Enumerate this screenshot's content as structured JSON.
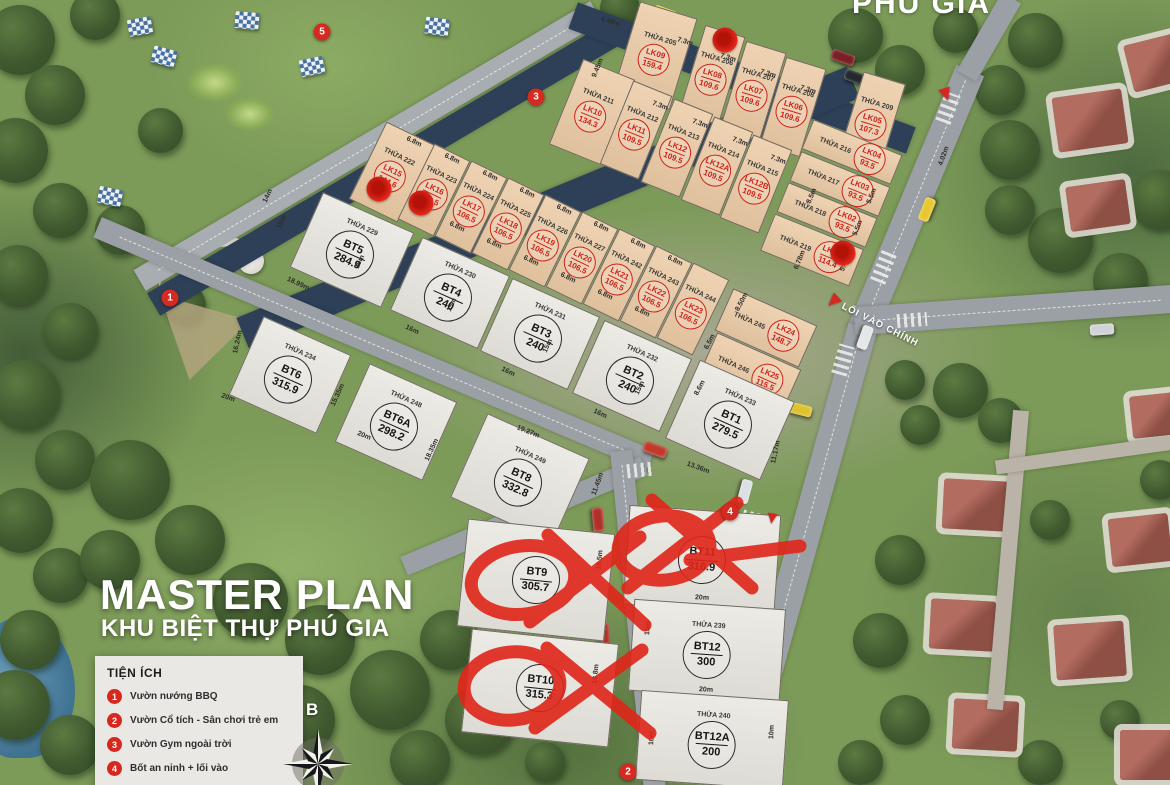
{
  "title": {
    "line1": "MASTER PLAN",
    "line2": "KHU BIỆT THỰ PHÚ GIA"
  },
  "watermark": "PHU GIA",
  "compass_label": "B",
  "entrance_label": "LỐI VÀO CHÍNH",
  "legend": {
    "title": "TIỆN ÍCH",
    "items": [
      {
        "num": "1",
        "label": "Vườn nướng BBQ"
      },
      {
        "num": "2",
        "label": "Vườn Cổ tích - Sân chơi trẻ em"
      },
      {
        "num": "3",
        "label": "Vườn Gym ngoài trời"
      },
      {
        "num": "4",
        "label": "Bốt an ninh + lối vào"
      }
    ]
  },
  "colors": {
    "annotation_red": "#e02519",
    "lk_badge_red": "#cf2319",
    "bt_badge_black": "#151515",
    "lk_fill": "#ebcba6",
    "bt_fill": "#e9e7e0"
  },
  "crossed_out_lots": [
    "BT9",
    "BT10",
    "BT11"
  ],
  "lots": [
    {
      "code": "LK09",
      "area": "159.4",
      "thua": "THỬA 205",
      "x": 655,
      "y": 55,
      "w": 60,
      "h": 95,
      "r": 17,
      "t": "lk"
    },
    {
      "code": "LK08",
      "area": "109.6",
      "thua": "THỬA 206",
      "x": 712,
      "y": 75,
      "w": 42,
      "h": 92,
      "r": 17,
      "t": "lk"
    },
    {
      "code": "LK07",
      "area": "109.6",
      "thua": "THỬA 207",
      "x": 753,
      "y": 91,
      "w": 42,
      "h": 92,
      "r": 17,
      "t": "lk"
    },
    {
      "code": "LK06",
      "area": "109.6",
      "thua": "THỬA 208",
      "x": 793,
      "y": 107,
      "w": 42,
      "h": 92,
      "r": 17,
      "t": "lk"
    },
    {
      "code": "LK05",
      "area": "107.3",
      "thua": "THỬA 209",
      "x": 872,
      "y": 120,
      "w": 44,
      "h": 88,
      "r": 17,
      "t": "lk"
    },
    {
      "code": "LK10",
      "area": "134.3",
      "thua": "THỬA 211",
      "x": 592,
      "y": 112,
      "w": 56,
      "h": 92,
      "r": 22,
      "t": "lk"
    },
    {
      "code": "LK11",
      "area": "109.5",
      "thua": "THỬA 212",
      "x": 636,
      "y": 130,
      "w": 42,
      "h": 90,
      "r": 22,
      "t": "lk"
    },
    {
      "code": "LK12",
      "area": "109.5",
      "thua": "THỬA 213",
      "x": 677,
      "y": 148,
      "w": 42,
      "h": 90,
      "r": 22,
      "t": "lk"
    },
    {
      "code": "LK12A",
      "area": "109.5",
      "thua": "THỬA 214",
      "x": 717,
      "y": 166,
      "w": 42,
      "h": 90,
      "r": 22,
      "t": "lk"
    },
    {
      "code": "LK12B",
      "area": "109.5",
      "thua": "THỬA 215",
      "x": 756,
      "y": 184,
      "w": 42,
      "h": 90,
      "r": 22,
      "t": "lk"
    },
    {
      "code": "LK04",
      "area": "93.5",
      "thua": "THỬA 216",
      "x": 852,
      "y": 152,
      "w": 96,
      "h": 32,
      "r": 22,
      "t": "lk"
    },
    {
      "code": "LK03",
      "area": "93.5",
      "thua": "THỬA 217",
      "x": 840,
      "y": 184,
      "w": 96,
      "h": 32,
      "r": 22,
      "t": "lk"
    },
    {
      "code": "LK02",
      "area": "93.5",
      "thua": "THỬA 218",
      "x": 827,
      "y": 215,
      "w": 96,
      "h": 32,
      "r": 22,
      "t": "lk"
    },
    {
      "code": "LK01",
      "area": "114.4",
      "thua": "THỬA 219",
      "x": 812,
      "y": 250,
      "w": 96,
      "h": 40,
      "r": 22,
      "t": "lk"
    },
    {
      "code": "LK15",
      "area": "144.6",
      "thua": "THỬA 222",
      "x": 392,
      "y": 172,
      "w": 54,
      "h": 86,
      "r": 26,
      "t": "lk"
    },
    {
      "code": "LK16",
      "area": "106.5",
      "thua": "THỬA 223",
      "x": 434,
      "y": 190,
      "w": 40,
      "h": 84,
      "r": 26,
      "t": "lk"
    },
    {
      "code": "LK17",
      "area": "106.5",
      "thua": "THỬA 224",
      "x": 471,
      "y": 207,
      "w": 40,
      "h": 84,
      "r": 26,
      "t": "lk"
    },
    {
      "code": "LK18",
      "area": "106.5",
      "thua": "THỬA 225",
      "x": 508,
      "y": 224,
      "w": 40,
      "h": 84,
      "r": 26,
      "t": "lk"
    },
    {
      "code": "LK19",
      "area": "106.5",
      "thua": "THỬA 226",
      "x": 545,
      "y": 241,
      "w": 40,
      "h": 84,
      "r": 26,
      "t": "lk"
    },
    {
      "code": "LK20",
      "area": "106.5",
      "thua": "THỬA 227",
      "x": 582,
      "y": 258,
      "w": 40,
      "h": 84,
      "r": 26,
      "t": "lk"
    },
    {
      "code": "LK21",
      "area": "106.5",
      "thua": "THỬA 242",
      "x": 619,
      "y": 275,
      "w": 40,
      "h": 84,
      "r": 26,
      "t": "lk"
    },
    {
      "code": "LK22",
      "area": "106.5",
      "thua": "THỬA 243",
      "x": 656,
      "y": 292,
      "w": 40,
      "h": 84,
      "r": 26,
      "t": "lk"
    },
    {
      "code": "LK23",
      "area": "106.5",
      "thua": "THỬA 244",
      "x": 693,
      "y": 309,
      "w": 40,
      "h": 84,
      "r": 26,
      "t": "lk"
    },
    {
      "code": "LK24",
      "area": "148.7",
      "thua": "THỬA 245",
      "x": 766,
      "y": 328,
      "w": 92,
      "h": 46,
      "r": 24,
      "t": "lk"
    },
    {
      "code": "LK25",
      "area": "115.5",
      "thua": "THỬA 246",
      "x": 750,
      "y": 372,
      "w": 92,
      "h": 46,
      "r": 24,
      "t": "lk"
    },
    {
      "code": "BT5",
      "area": "284.9",
      "thua": "THỬA 229",
      "x": 352,
      "y": 250,
      "w": 100,
      "h": 82,
      "r": 24,
      "t": "bt"
    },
    {
      "code": "BT4",
      "area": "240",
      "thua": "THỬA 230",
      "x": 450,
      "y": 293,
      "w": 96,
      "h": 80,
      "r": 24,
      "t": "bt"
    },
    {
      "code": "BT3",
      "area": "240",
      "thua": "THỬA 231",
      "x": 540,
      "y": 334,
      "w": 96,
      "h": 80,
      "r": 24,
      "t": "bt"
    },
    {
      "code": "BT2",
      "area": "240",
      "thua": "THỬA 232",
      "x": 632,
      "y": 376,
      "w": 96,
      "h": 80,
      "r": 24,
      "t": "bt"
    },
    {
      "code": "BT1",
      "area": "279.5",
      "thua": "THỬA 233",
      "x": 730,
      "y": 420,
      "w": 104,
      "h": 86,
      "r": 24,
      "t": "bt"
    },
    {
      "code": "BT6",
      "area": "315.9",
      "thua": "THỬA 234",
      "x": 290,
      "y": 375,
      "w": 96,
      "h": 86,
      "r": 24,
      "t": "bt"
    },
    {
      "code": "BT6A",
      "area": "298.2",
      "thua": "THỬA 248",
      "x": 396,
      "y": 422,
      "w": 96,
      "h": 86,
      "r": 24,
      "t": "bt"
    },
    {
      "code": "BT8",
      "area": "332.8",
      "thua": "THỬA 249",
      "x": 520,
      "y": 478,
      "w": 112,
      "h": 92,
      "r": 24,
      "t": "bt"
    },
    {
      "code": "BT9",
      "area": "305.7",
      "thua": "",
      "x": 536,
      "y": 580,
      "w": 148,
      "h": 108,
      "r": 6,
      "t": "bt"
    },
    {
      "code": "BT10",
      "area": "315.3",
      "thua": "",
      "x": 540,
      "y": 688,
      "w": 148,
      "h": 104,
      "r": 6,
      "t": "bt"
    },
    {
      "code": "BT11",
      "area": "316.9",
      "thua": "",
      "x": 702,
      "y": 560,
      "w": 152,
      "h": 100,
      "r": 4,
      "t": "bt"
    },
    {
      "code": "BT12",
      "area": "300",
      "thua": "THỬA 239",
      "x": 707,
      "y": 650,
      "w": 152,
      "h": 92,
      "r": 4,
      "t": "bt"
    },
    {
      "code": "BT12A",
      "area": "200",
      "thua": "THỬA 240",
      "x": 712,
      "y": 740,
      "w": 148,
      "h": 90,
      "r": 4,
      "t": "bt"
    }
  ],
  "map_markers": [
    {
      "num": "1",
      "x": 170,
      "y": 298
    },
    {
      "num": "2",
      "x": 628,
      "y": 772
    },
    {
      "num": "3",
      "x": 536,
      "y": 97
    },
    {
      "num": "4",
      "x": 730,
      "y": 512
    },
    {
      "num": "5",
      "x": 322,
      "y": 32
    }
  ],
  "red_dots": [
    {
      "x": 725,
      "y": 40
    },
    {
      "x": 379,
      "y": 189
    },
    {
      "x": 421,
      "y": 203
    },
    {
      "x": 843,
      "y": 253
    }
  ],
  "dimensions": [
    {
      "t": "4.48m",
      "x": 610,
      "y": 22,
      "r": 17
    },
    {
      "t": "7.3m",
      "x": 685,
      "y": 42,
      "r": 17
    },
    {
      "t": "7.3m",
      "x": 728,
      "y": 58,
      "r": 17
    },
    {
      "t": "7.3m",
      "x": 768,
      "y": 74,
      "r": 17
    },
    {
      "t": "7.3m",
      "x": 808,
      "y": 90,
      "r": 17
    },
    {
      "t": "9.45m",
      "x": 598,
      "y": 68,
      "r": -68
    },
    {
      "t": "7.3m",
      "x": 660,
      "y": 106,
      "r": 20
    },
    {
      "t": "7.3m",
      "x": 700,
      "y": 124,
      "r": 20
    },
    {
      "t": "7.3m",
      "x": 740,
      "y": 142,
      "r": 20
    },
    {
      "t": "7.3m",
      "x": 778,
      "y": 160,
      "r": 20
    },
    {
      "t": "4.02m",
      "x": 944,
      "y": 156,
      "r": -70
    },
    {
      "t": "8.5m",
      "x": 812,
      "y": 196,
      "r": -68
    },
    {
      "t": "5.5m",
      "x": 872,
      "y": 196,
      "r": -68
    },
    {
      "t": "5.5m",
      "x": 858,
      "y": 228,
      "r": -68
    },
    {
      "t": "5.42m",
      "x": 846,
      "y": 262,
      "r": -68
    },
    {
      "t": "6.78m",
      "x": 800,
      "y": 260,
      "r": -68
    },
    {
      "t": "6.8m",
      "x": 414,
      "y": 142,
      "r": 26
    },
    {
      "t": "6.8m",
      "x": 452,
      "y": 159,
      "r": 26
    },
    {
      "t": "6.8m",
      "x": 490,
      "y": 176,
      "r": 26
    },
    {
      "t": "6.8m",
      "x": 527,
      "y": 193,
      "r": 26
    },
    {
      "t": "6.8m",
      "x": 564,
      "y": 210,
      "r": 26
    },
    {
      "t": "6.8m",
      "x": 601,
      "y": 227,
      "r": 26
    },
    {
      "t": "6.8m",
      "x": 638,
      "y": 244,
      "r": 26
    },
    {
      "t": "6.8m",
      "x": 675,
      "y": 261,
      "r": 26
    },
    {
      "t": "6.8m",
      "x": 420,
      "y": 210,
      "r": 26
    },
    {
      "t": "6.8m",
      "x": 457,
      "y": 227,
      "r": 26
    },
    {
      "t": "6.8m",
      "x": 494,
      "y": 244,
      "r": 26
    },
    {
      "t": "6.8m",
      "x": 531,
      "y": 261,
      "r": 26
    },
    {
      "t": "6.8m",
      "x": 568,
      "y": 278,
      "r": 26
    },
    {
      "t": "6.8m",
      "x": 605,
      "y": 295,
      "r": 26
    },
    {
      "t": "6.8m",
      "x": 642,
      "y": 312,
      "r": 26
    },
    {
      "t": "14m",
      "x": 268,
      "y": 196,
      "r": -65
    },
    {
      "t": "15m",
      "x": 282,
      "y": 222,
      "r": -65
    },
    {
      "t": "18.99m",
      "x": 298,
      "y": 284,
      "r": 25
    },
    {
      "t": "16m",
      "x": 412,
      "y": 330,
      "r": 25
    },
    {
      "t": "16m",
      "x": 508,
      "y": 372,
      "r": 25
    },
    {
      "t": "16m",
      "x": 600,
      "y": 414,
      "r": 25
    },
    {
      "t": "15m",
      "x": 360,
      "y": 262,
      "r": -65
    },
    {
      "t": "15m",
      "x": 452,
      "y": 305,
      "r": -65
    },
    {
      "t": "15m",
      "x": 548,
      "y": 346,
      "r": -65
    },
    {
      "t": "15m",
      "x": 640,
      "y": 388,
      "r": -65
    },
    {
      "t": "16.24m",
      "x": 238,
      "y": 342,
      "r": -78
    },
    {
      "t": "20m",
      "x": 228,
      "y": 398,
      "r": 20
    },
    {
      "t": "15.35m",
      "x": 338,
      "y": 395,
      "r": -65
    },
    {
      "t": "20m",
      "x": 364,
      "y": 436,
      "r": 22
    },
    {
      "t": "18.35m",
      "x": 432,
      "y": 450,
      "r": -65
    },
    {
      "t": "19.27m",
      "x": 528,
      "y": 432,
      "r": 22
    },
    {
      "t": "11.45m",
      "x": 598,
      "y": 484,
      "r": -70
    },
    {
      "t": "13.36m",
      "x": 698,
      "y": 468,
      "r": 20
    },
    {
      "t": "11.17m",
      "x": 776,
      "y": 452,
      "r": -78
    },
    {
      "t": "8.50m",
      "x": 742,
      "y": 302,
      "r": -62
    },
    {
      "t": "6.5m",
      "x": 710,
      "y": 342,
      "r": -62
    },
    {
      "t": "8.6m",
      "x": 700,
      "y": 388,
      "r": -62
    },
    {
      "t": "20m",
      "x": 702,
      "y": 598,
      "r": 3
    },
    {
      "t": "20m",
      "x": 706,
      "y": 690,
      "r": 3
    },
    {
      "t": "15m",
      "x": 648,
      "y": 628,
      "r": -87
    },
    {
      "t": "10m",
      "x": 652,
      "y": 738,
      "r": -87
    },
    {
      "t": "10m",
      "x": 772,
      "y": 732,
      "r": -87
    },
    {
      "t": "18.8m",
      "x": 596,
      "y": 674,
      "r": -85
    },
    {
      "t": "18.5m",
      "x": 600,
      "y": 560,
      "r": -85
    }
  ]
}
